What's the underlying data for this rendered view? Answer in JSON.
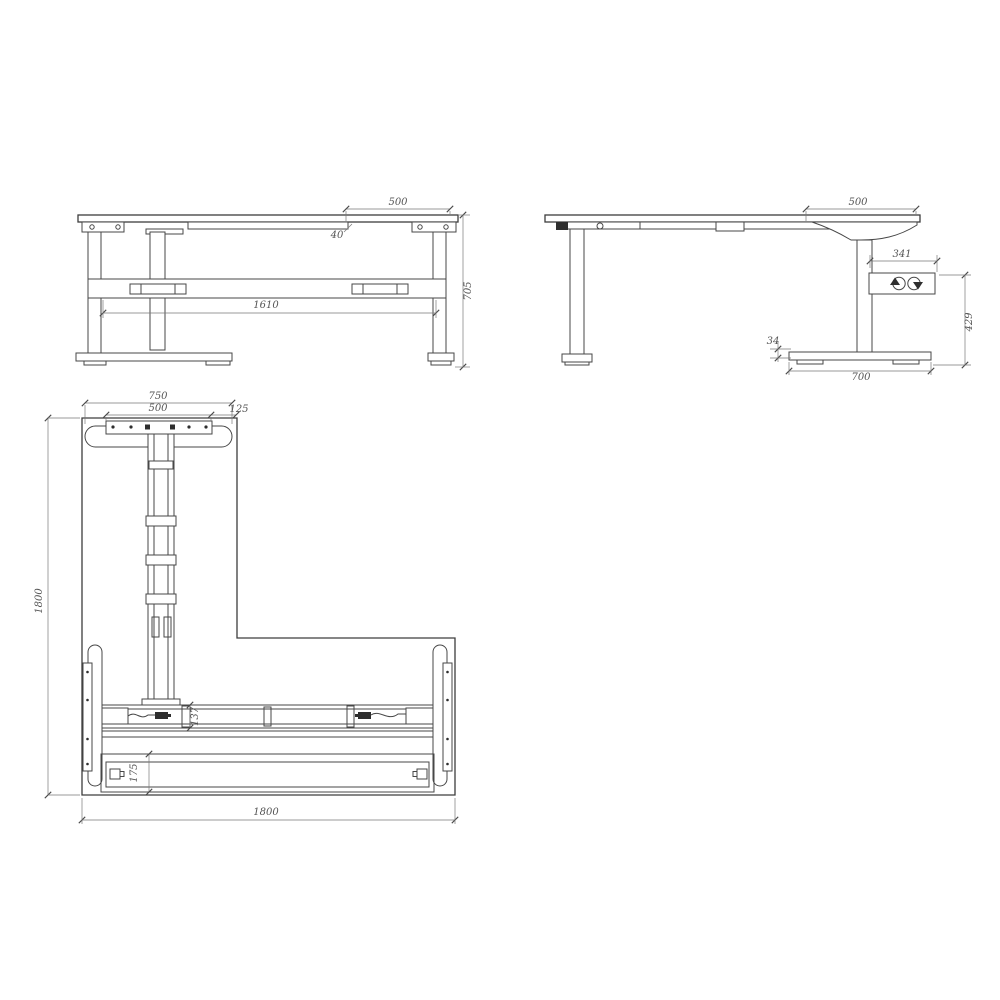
{
  "drawing": {
    "type": "technical-drawing",
    "subject": "L-shaped height adjustable desk frame, three orthographic views",
    "colors": {
      "background": "#ffffff",
      "line": "#474747",
      "dimension": "#555555"
    },
    "front_view": {
      "top_width": "500",
      "top_drop": "40",
      "frame_span": "1610",
      "height": "705"
    },
    "side_view": {
      "top_overhang": "500",
      "box_span": "341",
      "box_to_floor": "429",
      "foot_height": "34",
      "foot_length": "700"
    },
    "plan_view": {
      "foot_length": "750",
      "plate_span": "500",
      "edge_offset": "125",
      "depth": "1800",
      "width": "1800",
      "beam_depth": "137",
      "fascia_depth": "175"
    }
  }
}
